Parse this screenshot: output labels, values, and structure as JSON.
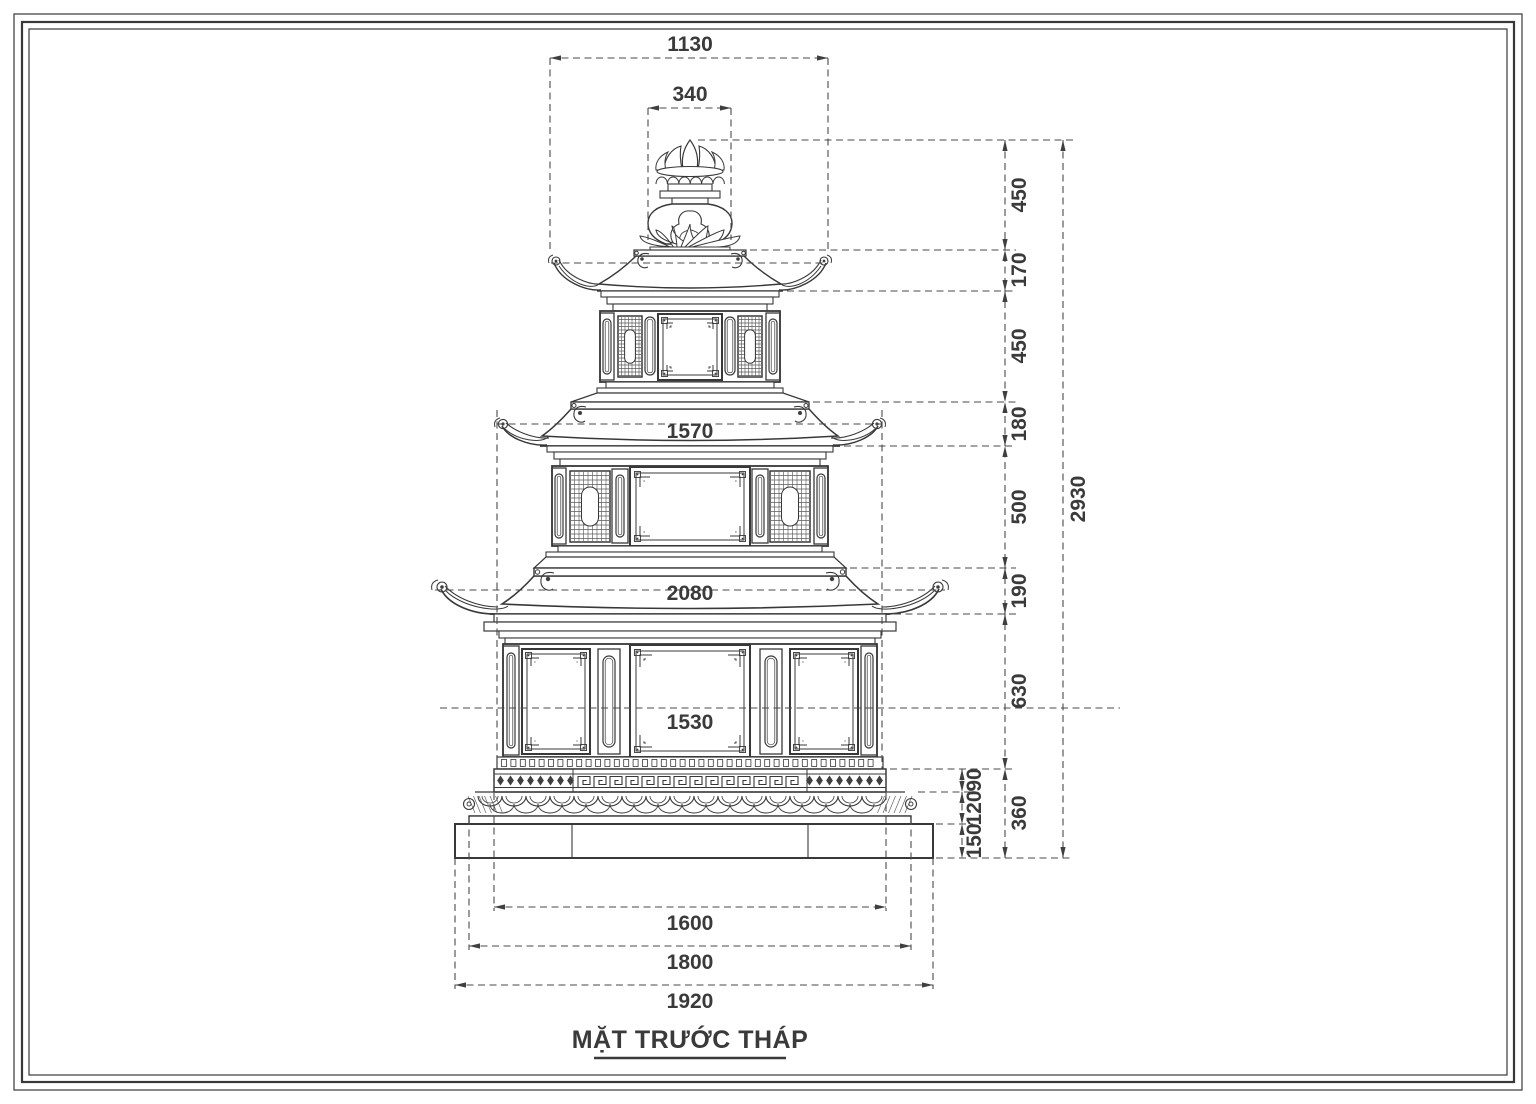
{
  "title": {
    "text": "MẶT TRƯỚC THÁP"
  },
  "drawing": {
    "subject": "three-tier stone pagoda front elevation",
    "units": "mm",
    "line_color": "#383838",
    "background": "#ffffff"
  },
  "dimensions": {
    "top_roof_width": "1130",
    "finial_width": "340",
    "tier2_roof_width": "1570",
    "tier1_roof_width": "2080",
    "tier1_body_width": "1530",
    "base_upper_width": "1600",
    "base_middle_width": "1800",
    "base_lower_width": "1920",
    "finial_height": "450",
    "tier3_roof_height": "170",
    "tier3_body_height": "450",
    "tier2_roof_height": "180",
    "tier2_body_height": "500",
    "tier1_roof_height": "190",
    "tier1_body_height": "630",
    "plinth_band_height": "90",
    "plinth_molding_height": "120",
    "plinth_slab_height": "150",
    "plinth_total_height": "360",
    "total_height": "2930"
  }
}
